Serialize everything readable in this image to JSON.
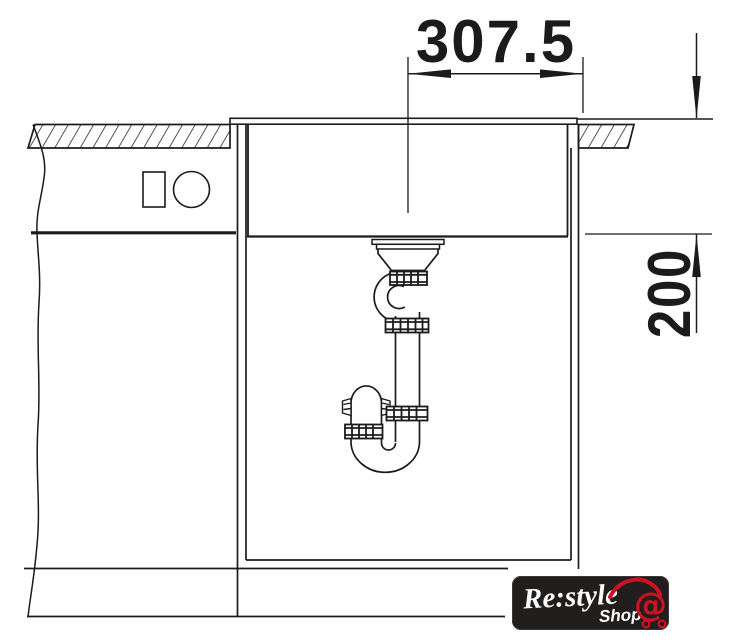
{
  "drawing": {
    "dimensions": {
      "top_width_mm": "307.5",
      "right_depth_mm": "200"
    },
    "line_color": "#1b1b1b",
    "background_color": "#ffffff"
  },
  "logo": {
    "brand": "Re:style",
    "sub_label": "Shop",
    "cart_symbol": "@",
    "cart_icon": "shopping-cart-at-icon",
    "bg_color": "#211e1d",
    "accent_color": "#cf1125",
    "text_color": "#ffffff"
  }
}
